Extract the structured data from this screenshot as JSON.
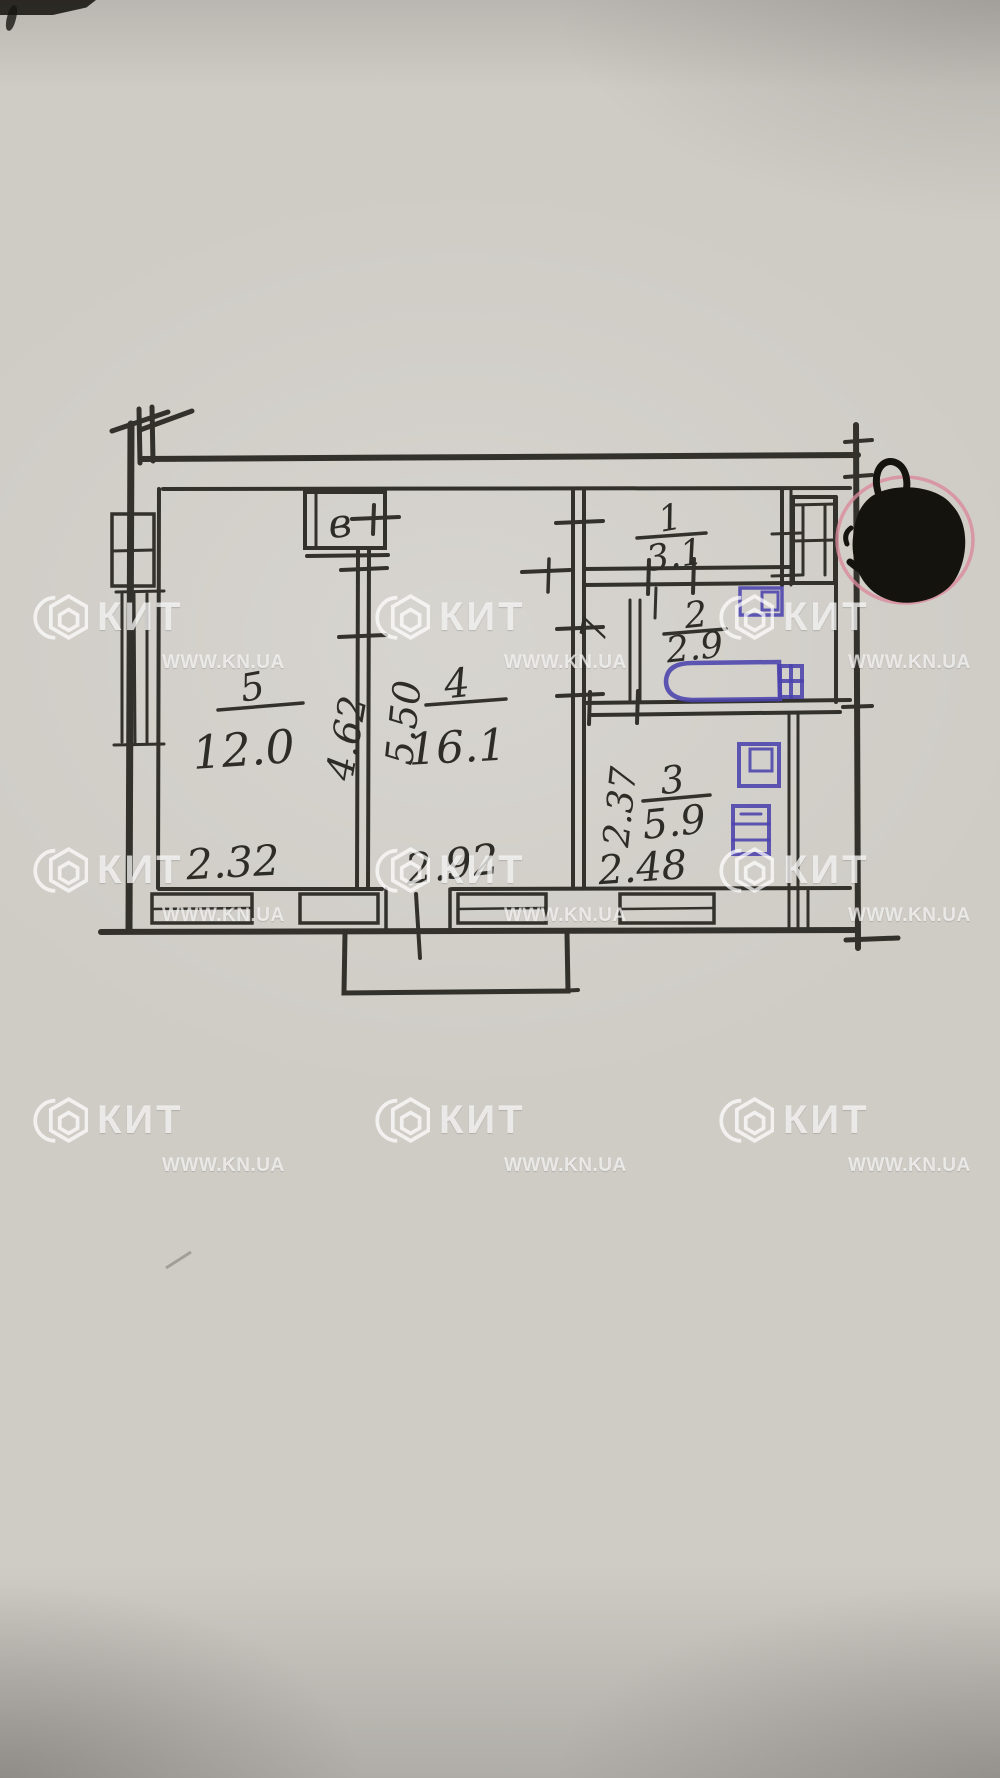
{
  "photo": {
    "watermark": {
      "brand": "КИТ",
      "url": "WWW.KN.UA"
    }
  },
  "plan": {
    "vent_label": "в",
    "room5": {
      "num": "5",
      "area": "12.0",
      "dim_bottom": "2.32",
      "dim_side": "4.62"
    },
    "room4": {
      "num": "4",
      "area": "16.1",
      "dim_bottom": "2.92",
      "dim_side": "5.50"
    },
    "room1": {
      "num": "1",
      "area": "3.1"
    },
    "closet7": {
      "num": "7"
    },
    "room2": {
      "num": "2",
      "area": "2.9"
    },
    "room3": {
      "num": "3",
      "area": "5.9",
      "dim_bottom": "2.48",
      "dim_side": "2.37"
    }
  }
}
